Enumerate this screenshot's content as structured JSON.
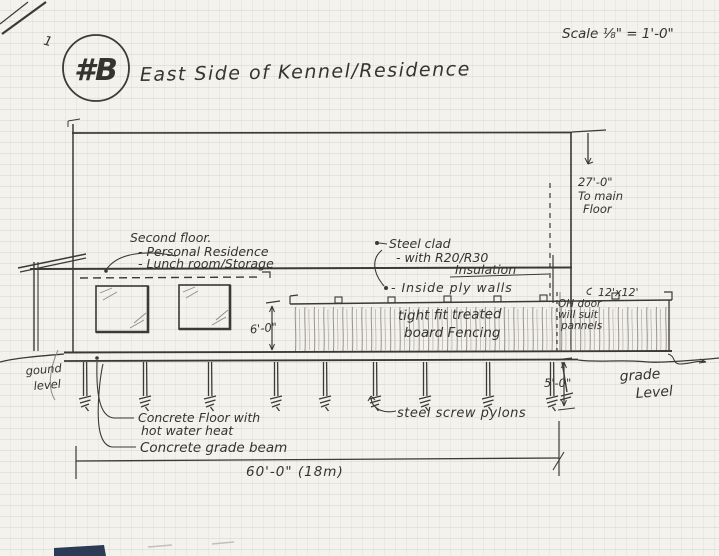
{
  "colors": {
    "paper": "#f4f2ec",
    "ink": "#3b3a37",
    "pencil": "#8e8b85",
    "grid_line": "#d8d6cf",
    "smudge": "#2c3a55"
  },
  "header": {
    "sheet_mark": "1",
    "badge": "#B",
    "title": "East Side of Kennel/Residence",
    "scale_note": "Scale ⅛\" = 1'-0\""
  },
  "annotations": {
    "second_floor": {
      "title": "Second floor.",
      "item1": "- Personal Residence",
      "item2": "- Lunch room/Storage"
    },
    "cladding": {
      "line1": "Steel clad",
      "line2": "- with R20/R30",
      "line3": "Insulation",
      "line4": "- Inside ply walls"
    },
    "height_to_main": {
      "dim": "27'-0\"",
      "line2": "To main",
      "line3": "Floor"
    },
    "oh_door": {
      "size": "12'x12'",
      "line2": "OH door",
      "line3": "will suit",
      "line4": "pannels"
    },
    "fencing": {
      "line1": "tight fit treated",
      "line2": "board Fencing"
    },
    "fence_height": "6'-0\"",
    "pylon_depth": "5'-0\"",
    "grade_right": {
      "line1": "grade",
      "line2": "Level"
    },
    "ground_left": {
      "line1": "gound",
      "line2": "level"
    },
    "floor_note": {
      "line1": "Concrete Floor with",
      "line2": "hot water heat"
    },
    "beam_note": "Concrete grade beam",
    "pylons_note": "steel screw pylons",
    "overall_width": "60'-0\" (18m)"
  }
}
